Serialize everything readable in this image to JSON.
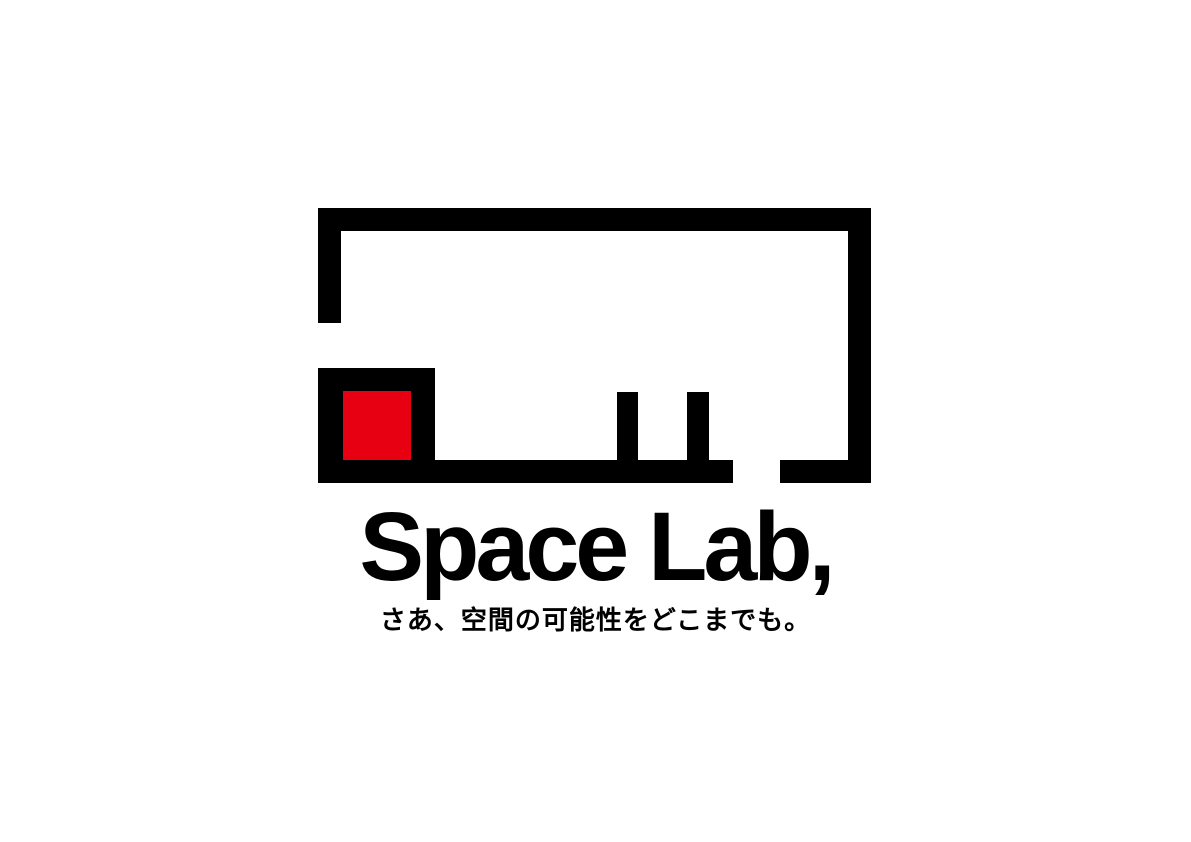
{
  "logo": {
    "wordmark": "Space Lab,",
    "tagline": "さあ、空間の可能性をどこまでも。",
    "mark": "floorplan-room-mark",
    "colors": {
      "ink": "#000000",
      "accent_red": "#e60012",
      "background": "#ffffff"
    }
  }
}
